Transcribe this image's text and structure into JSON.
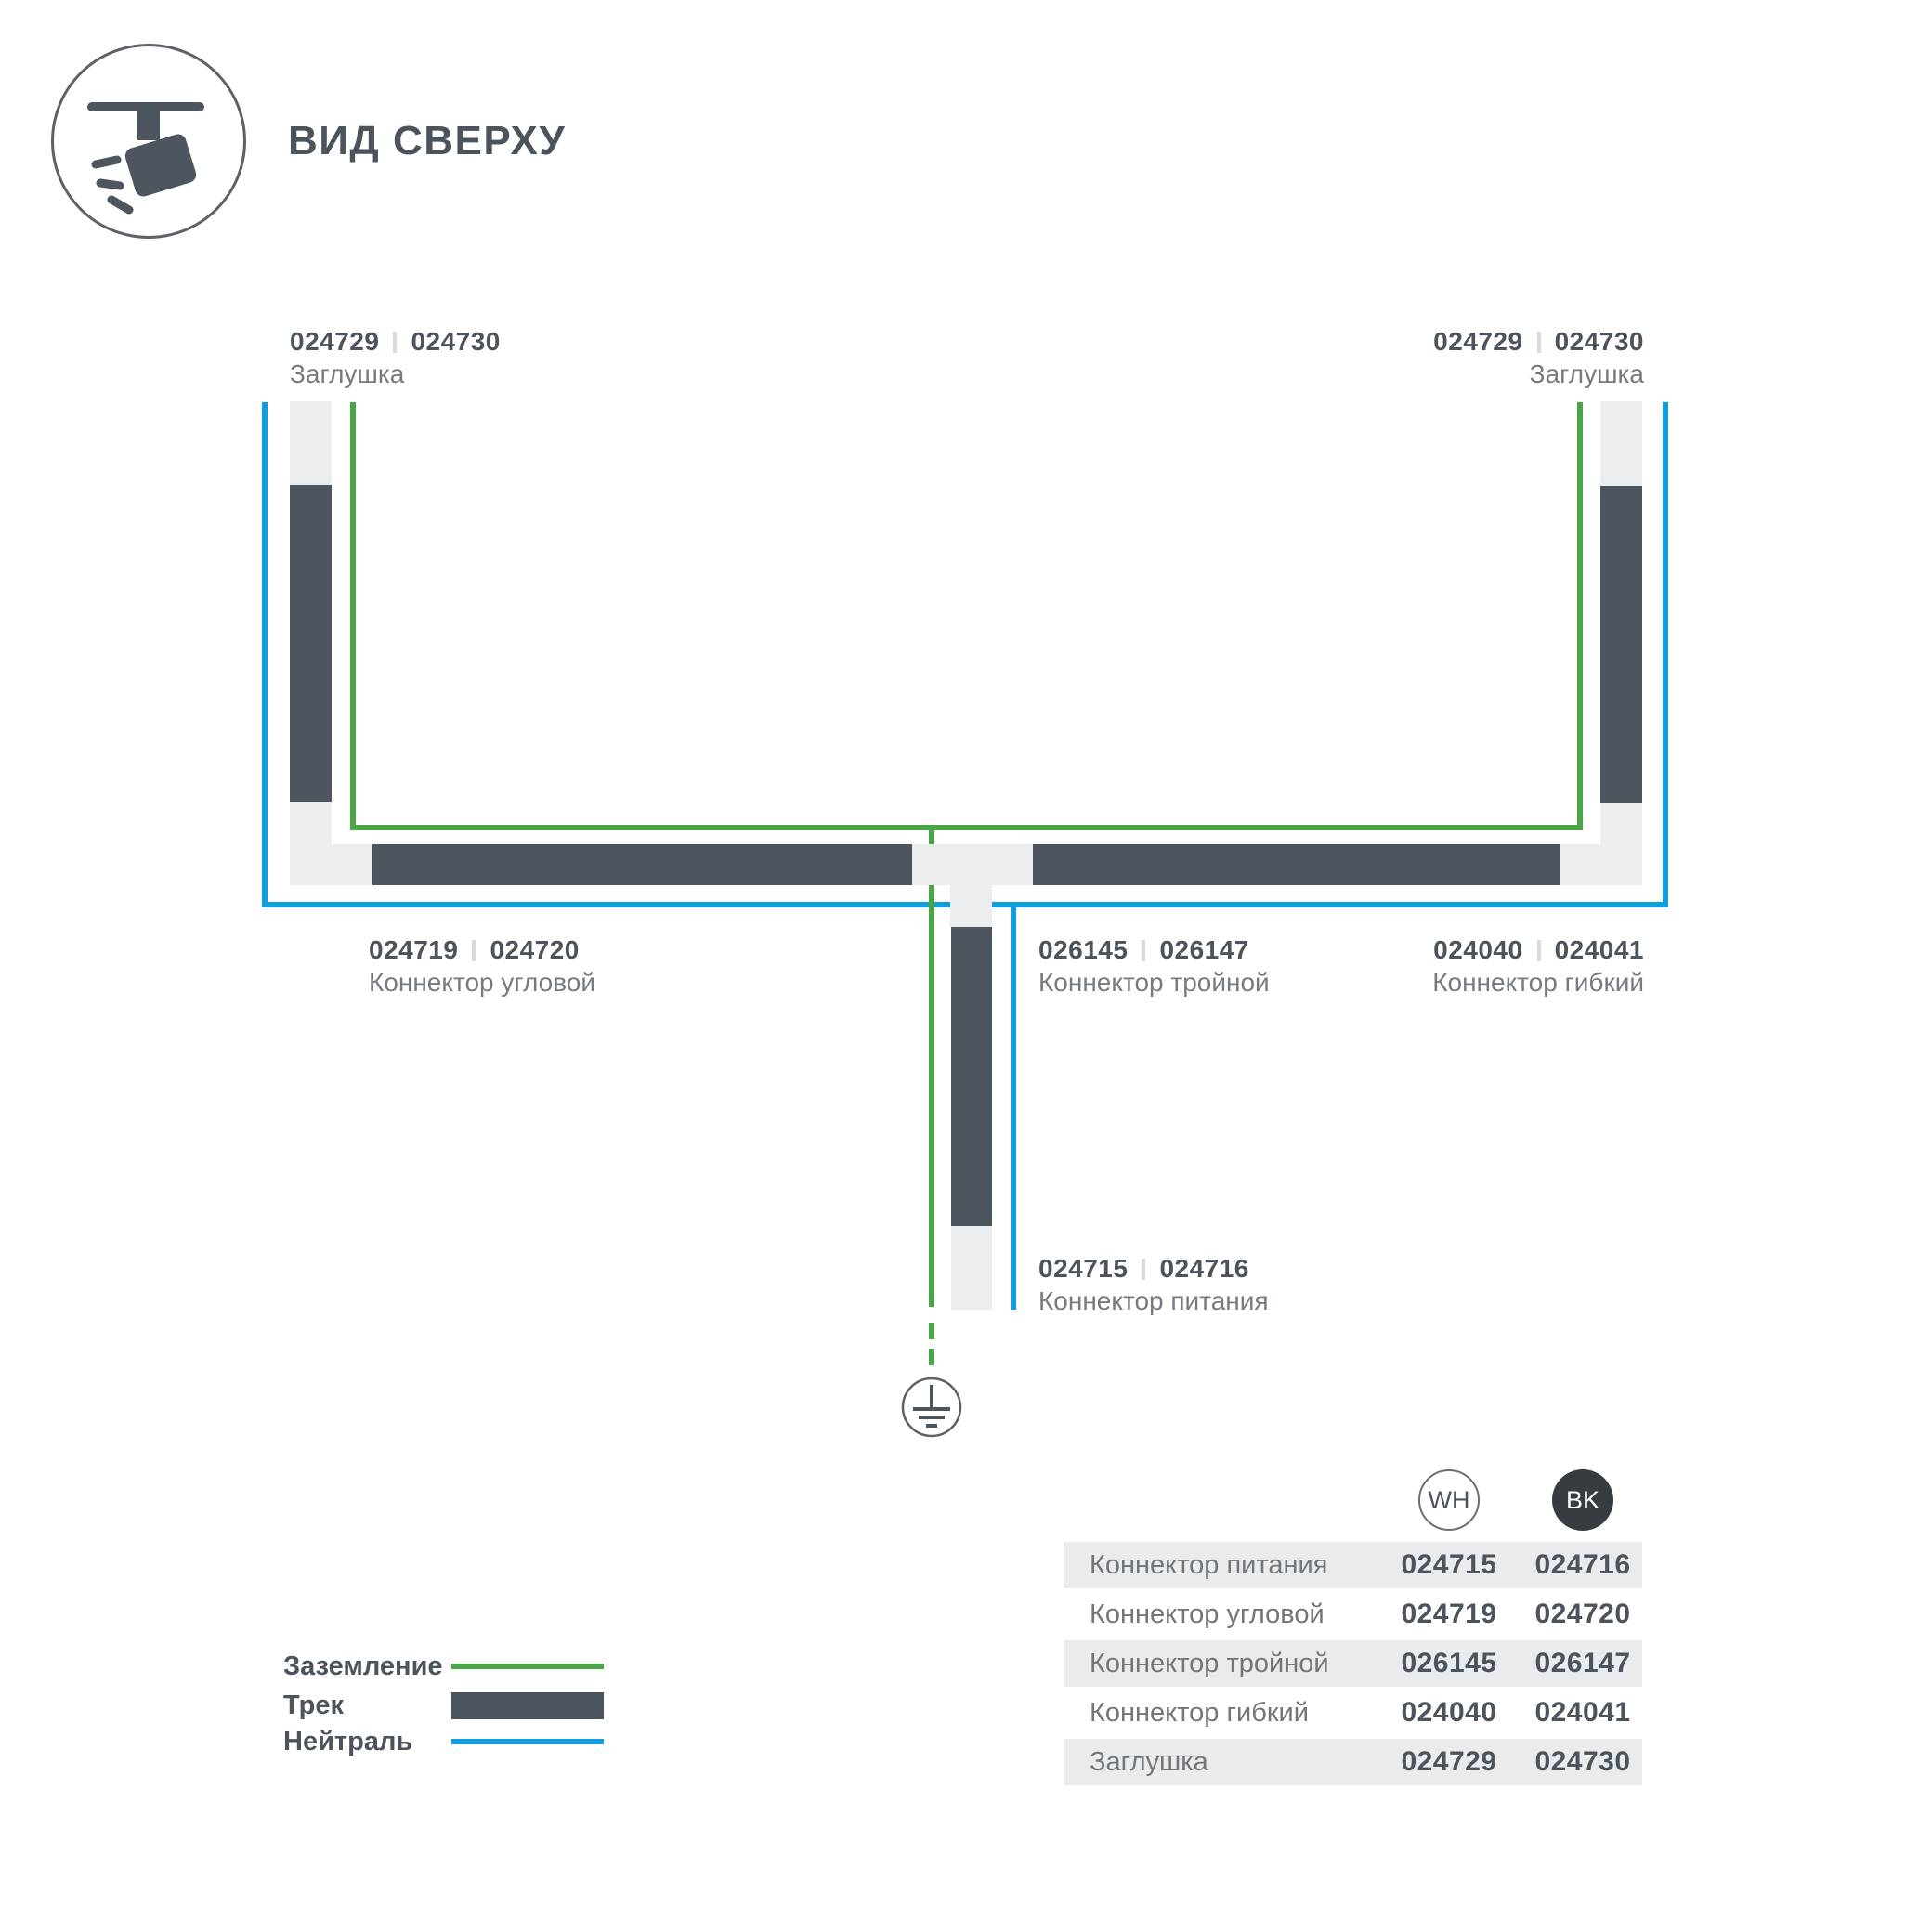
{
  "header": {
    "title": "ВИД СВЕРХУ",
    "icon": "track-spotlight-icon"
  },
  "colors": {
    "earth_green": "#4aa546",
    "neutral_blue": "#109ede",
    "track_dark": "#4d565e",
    "connector_light": "#ecedee"
  },
  "labels": {
    "endcap": {
      "wh": "024729",
      "bk": "024730",
      "name": "Заглушка"
    },
    "corner": {
      "wh": "024719",
      "bk": "024720",
      "name": "Коннектор угловой"
    },
    "triple": {
      "wh": "026145",
      "bk": "026147",
      "name": "Коннектор тройной"
    },
    "flex": {
      "wh": "024040",
      "bk": "024041",
      "name": "Коннектор гибкий"
    },
    "power": {
      "wh": "024715",
      "bk": "024716",
      "name": "Коннектор питания"
    }
  },
  "legend": {
    "items": [
      {
        "label": "Заземление",
        "swatch": "earth-line"
      },
      {
        "label": "Трек",
        "swatch": "track-bar"
      },
      {
        "label": "Нейтраль",
        "swatch": "neutral-line"
      }
    ]
  },
  "table": {
    "columns": [
      "WH",
      "BK"
    ],
    "rows": [
      {
        "name": "Коннектор питания",
        "wh": "024715",
        "bk": "024716"
      },
      {
        "name": "Коннектор угловой",
        "wh": "024719",
        "bk": "024720"
      },
      {
        "name": "Коннектор тройной",
        "wh": "026145",
        "bk": "026147"
      },
      {
        "name": "Коннектор гибкий",
        "wh": "024040",
        "bk": "024041"
      },
      {
        "name": "Заглушка",
        "wh": "024729",
        "bk": "024730"
      }
    ]
  }
}
